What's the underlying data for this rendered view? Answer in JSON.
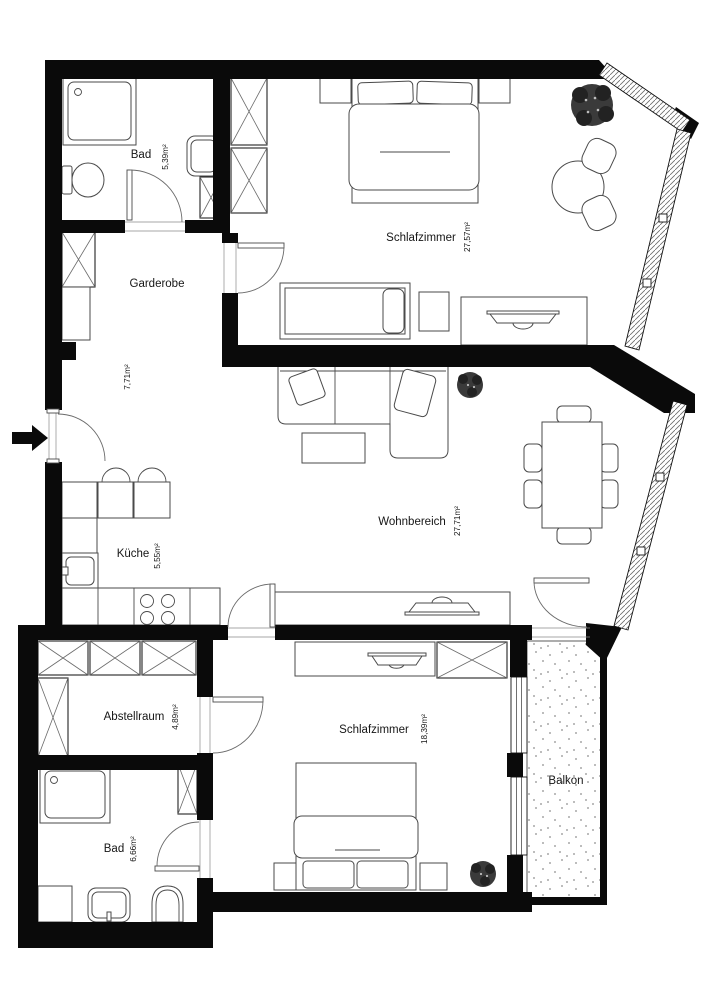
{
  "plan_type": "apartment-floor-plan",
  "rooms": {
    "bad_top": {
      "name": "Bad",
      "area": "5,39m²"
    },
    "schlafzimmer_top": {
      "name": "Schlafzimmer",
      "area": "27,57m²"
    },
    "garderobe": {
      "name": "Garderobe",
      "area": "7,71m²"
    },
    "kueche": {
      "name": "Küche",
      "area": "5,55m²"
    },
    "wohnbereich": {
      "name": "Wohnbereich",
      "area": "27,71m²"
    },
    "abstellraum": {
      "name": "Abstellraum",
      "area": "4,89m²"
    },
    "schlafzimmer_bottom": {
      "name": "Schlafzimmer",
      "area": "18,39m²"
    },
    "bad_bottom": {
      "name": "Bad",
      "area": "6,66m²"
    },
    "balkon": {
      "name": "Balkon"
    }
  },
  "icons": {
    "entry_arrow": "➤"
  },
  "colors": {
    "wall": "#0a0a0a",
    "furniture_line": "#4a4a4a",
    "text": "#161616",
    "plant": "#3a3a3a",
    "balcony_dot": "#999999",
    "background": "#ffffff"
  }
}
